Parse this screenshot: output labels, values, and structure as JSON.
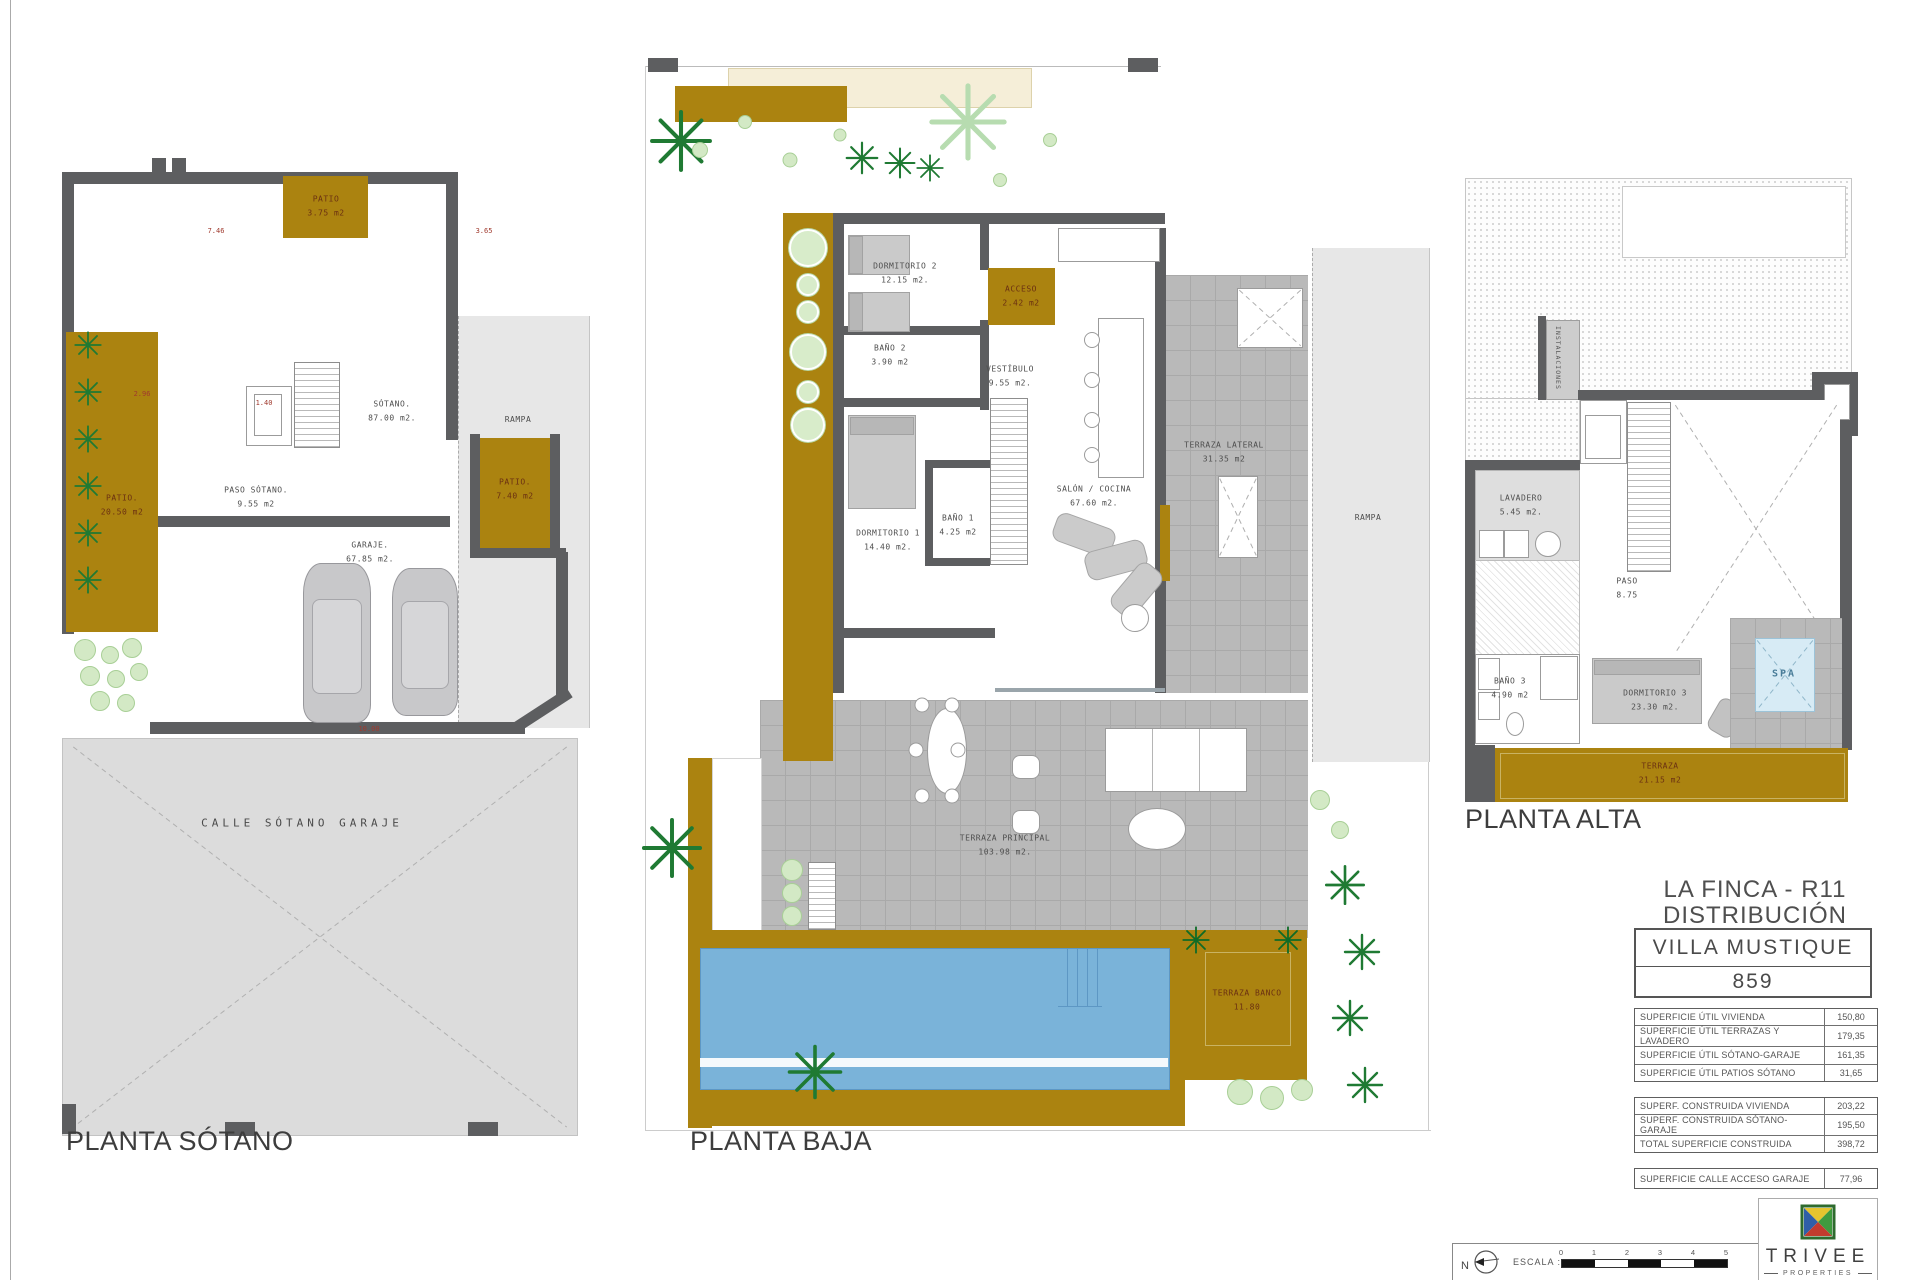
{
  "sheet": {
    "width": 1920,
    "height": 1280
  },
  "plans": {
    "sotano": {
      "title": "PLANTA SÓTANO",
      "rooms": {
        "patio_top": {
          "name": "PATIO",
          "area": "3.75 m2"
        },
        "patio_left": {
          "name": "PATIO.",
          "area": "20.50 m2"
        },
        "patio_right": {
          "name": "PATIO.",
          "area": "7.40 m2"
        },
        "sotano": {
          "name": "SÓTANO.",
          "area": "87.00 m2."
        },
        "paso": {
          "name": "PASO SÓTANO.",
          "area": "9.55 m2"
        },
        "garaje": {
          "name": "GARAJE.",
          "area": "67.85 m2."
        },
        "rampa": {
          "name": "RAMPA"
        },
        "calle": {
          "name": "CALLE SÓTANO GARAJE"
        }
      },
      "dims": {
        "d1": "7.46",
        "d2": "3.65",
        "d3": "2.96",
        "d4": "1.40",
        "d5": "10.00"
      }
    },
    "baja": {
      "title": "PLANTA BAJA",
      "rooms": {
        "dormitorio2": {
          "name": "DORMITORIO 2",
          "area": "12.15 m2."
        },
        "bano2": {
          "name": "BAÑO 2",
          "area": "3.90 m2"
        },
        "acceso": {
          "name": "ACCESO",
          "area": "2.42 m2"
        },
        "vestibulo": {
          "name": "VESTÍBULO",
          "area": "9.55 m2."
        },
        "dormitorio1": {
          "name": "DORMITORIO 1",
          "area": "14.40 m2."
        },
        "bano1": {
          "name": "BAÑO 1",
          "area": "4.25 m2"
        },
        "salon": {
          "name": "SALÓN / COCINA",
          "area": "67.60 m2."
        },
        "terraza_lateral": {
          "name": "TERRAZA LATERAL",
          "area": "31.35 m2"
        },
        "rampa": {
          "name": "RAMPA"
        },
        "terraza_principal": {
          "name": "TERRAZA PRINCIPAL",
          "area": "103.98 m2."
        },
        "terraza_banco": {
          "name": "TERRAZA BANCO",
          "area": "11.80"
        }
      }
    },
    "alta": {
      "title": "PLANTA ALTA",
      "rooms": {
        "instalaciones": {
          "name": "INSTALACIONES"
        },
        "lavadero": {
          "name": "LAVADERO",
          "area": "5.45 m2."
        },
        "paso": {
          "name": "PASO",
          "area": "8.75"
        },
        "bano3": {
          "name": "BAÑO 3",
          "area": "4.90 m2"
        },
        "dormitorio3": {
          "name": "DORMITORIO 3",
          "area": "23.30 m2."
        },
        "spa": {
          "name": "SPA"
        },
        "terraza": {
          "name": "TERRAZA",
          "area": "21.15 m2"
        }
      }
    }
  },
  "title_block": {
    "project_line1": "LA FINCA - R11",
    "project_line2": "DISTRIBUCIÓN",
    "villa_name": "VILLA  MUSTIQUE",
    "villa_number": "859",
    "table_util": [
      {
        "label": "SUPERFICIE ÚTIL VIVIENDA",
        "value": "150,80"
      },
      {
        "label": "SUPERFICIE ÚTIL TERRAZAS Y LAVADERO",
        "value": "179,35"
      },
      {
        "label": "SUPERFICIE ÚTIL SÓTANO-GARAJE",
        "value": "161,35"
      },
      {
        "label": "SUPERFICIE ÚTIL PATIOS SÓTANO",
        "value": "31,65"
      }
    ],
    "table_construida": [
      {
        "label": "SUPERF. CONSTRUIDA VIVIENDA",
        "value": "203,22"
      },
      {
        "label": "SUPERF. CONSTRUIDA SÓTANO-GARAJE",
        "value": "195,50"
      },
      {
        "label": "TOTAL SUPERFICIE CONSTRUIDA",
        "value": "398,72"
      }
    ],
    "table_calle": [
      {
        "label": "SUPERFICIE CALLE ACCESO GARAJE",
        "value": "77,96"
      }
    ]
  },
  "footer": {
    "north_label": "N",
    "escala_label": "ESCALA :",
    "scale_ticks": [
      "0",
      "1",
      "2",
      "3",
      "4",
      "5"
    ]
  },
  "logo": {
    "name": "TRIVEE",
    "sub": "PROPERTIES"
  },
  "colors": {
    "gold": "#ab8310",
    "wall_gray": "#5d5e60",
    "tile_gray": "#b9b9b9",
    "street_gray": "#dcdcdc",
    "rampa_gray": "#e7e7e7",
    "pool_blue": "#7ab3d9",
    "spa_blue": "#d7ebf5",
    "palm_green": "#1f7a33",
    "bush_green": "#d3e9c5",
    "cream": "#f5eed8",
    "gold_label_red": "#6b3012",
    "room_label_gray": "#4e4e4e",
    "logo_yellow": "#e5c42f",
    "logo_green": "#3f9b3f",
    "logo_blue": "#2f5fa8",
    "logo_red": "#c23b2e"
  }
}
